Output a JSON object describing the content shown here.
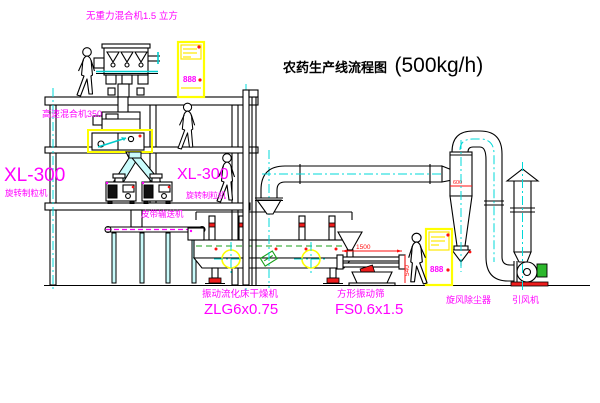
{
  "title": {
    "main": "农药生产线流程图",
    "capacity": "(500kg/h)"
  },
  "labels": {
    "gravity_mixer": "无重力混合机1.5 立方",
    "high_speed_mixer": "高速混合机350",
    "granulator_left_model": "XL-300",
    "granulator_left_name": "旋转制粒机",
    "granulator_right_model": "XL-300",
    "granulator_right_name": "旋转制粒机",
    "belt_conveyor": "皮带输送机",
    "dryer_name": "振动流化床干燥机",
    "dryer_model": "ZLG6x0.75",
    "screen_name": "方形振动筛",
    "screen_model": "FS0.6x1.5",
    "cyclone": "旋风除尘器",
    "fan": "引风机"
  },
  "dimensions": {
    "screen_length": "1500",
    "screen_height": "540",
    "cyclone_width": "600"
  },
  "cabinets": {
    "cabinet1_display": "888",
    "cabinet2_display": "888"
  },
  "colors": {
    "background": "#ffffff",
    "line_black": "#000000",
    "centerline_cyan": "#00d8d8",
    "label_magenta": "#ff00ff",
    "highlight_yellow": "#ffff00",
    "title_red": "#cc3333",
    "accent_red": "#ff1010",
    "accent_green": "#18a018"
  }
}
